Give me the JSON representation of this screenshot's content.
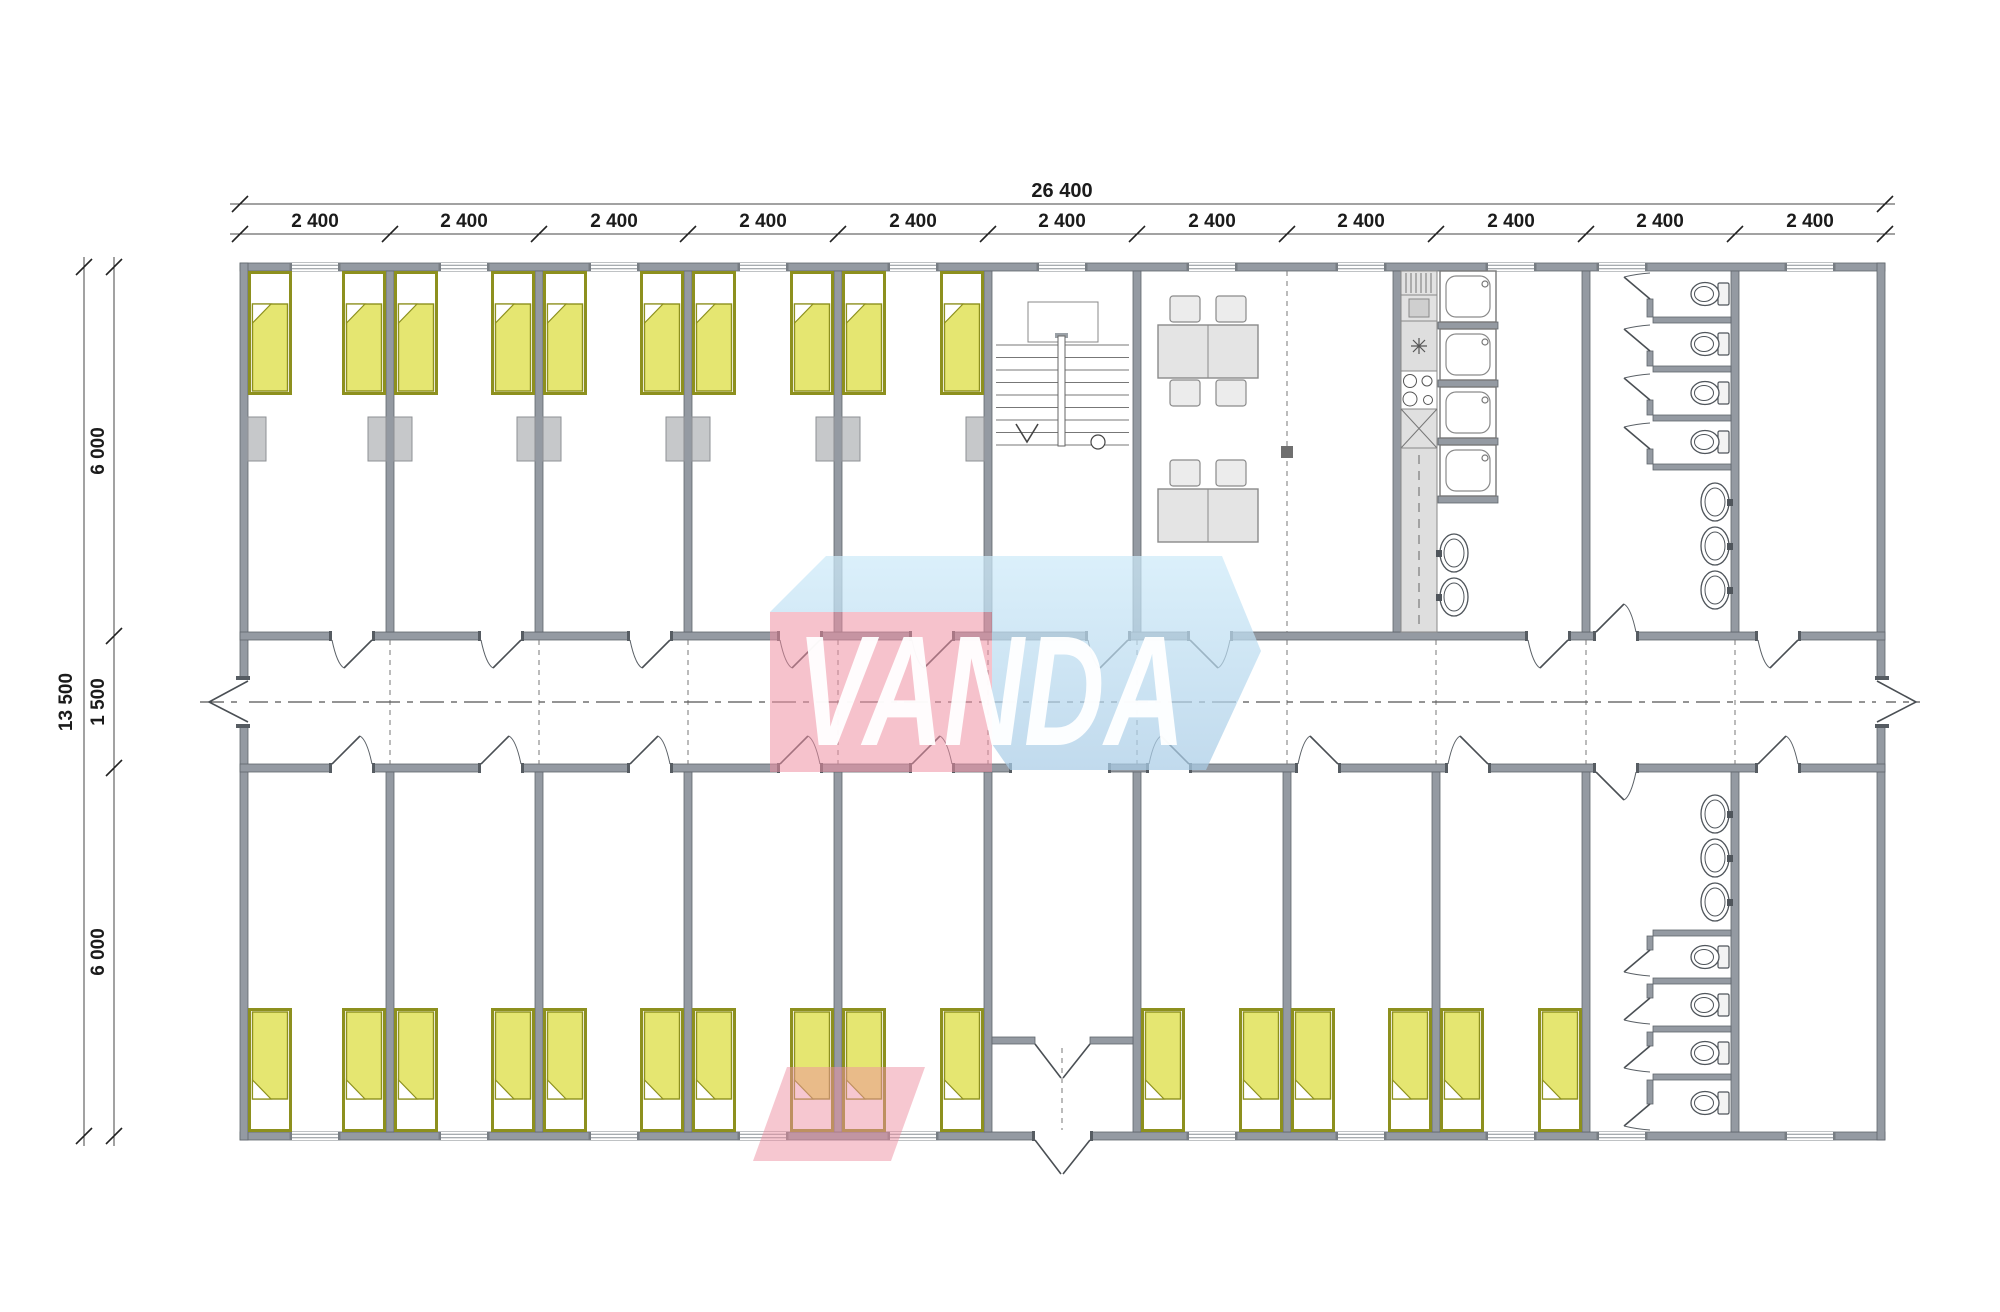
{
  "dimensions": {
    "horizontal": {
      "total": "26 400",
      "segments": [
        "2 400",
        "2 400",
        "2 400",
        "2 400",
        "2 400",
        "2 400",
        "2 400",
        "2 400",
        "2 400",
        "2 400",
        "2 400"
      ]
    },
    "vertical": {
      "total": "13 500",
      "segments": [
        "6 000",
        "1 500",
        "6 000"
      ]
    }
  },
  "watermark": {
    "text": "VANDA",
    "pink_color": "#ee8fa2",
    "blue_color": "#b9d9ee"
  },
  "colors": {
    "wall": "#949aa2",
    "bed_blanket": "#e5e671",
    "bed_frame": "#8d901e",
    "locker": "#c6c8ca",
    "furniture": "#e6e6e6",
    "dimension_text": "#1b1b1b",
    "dash_line": "#777777"
  },
  "symbols": {
    "bed_count": 26,
    "locker_count": 10,
    "shower_count": 4,
    "toilet_count": 8,
    "washbasin_count": 8,
    "table_count": 2,
    "chair_count": 8,
    "staircase_count": 1
  }
}
